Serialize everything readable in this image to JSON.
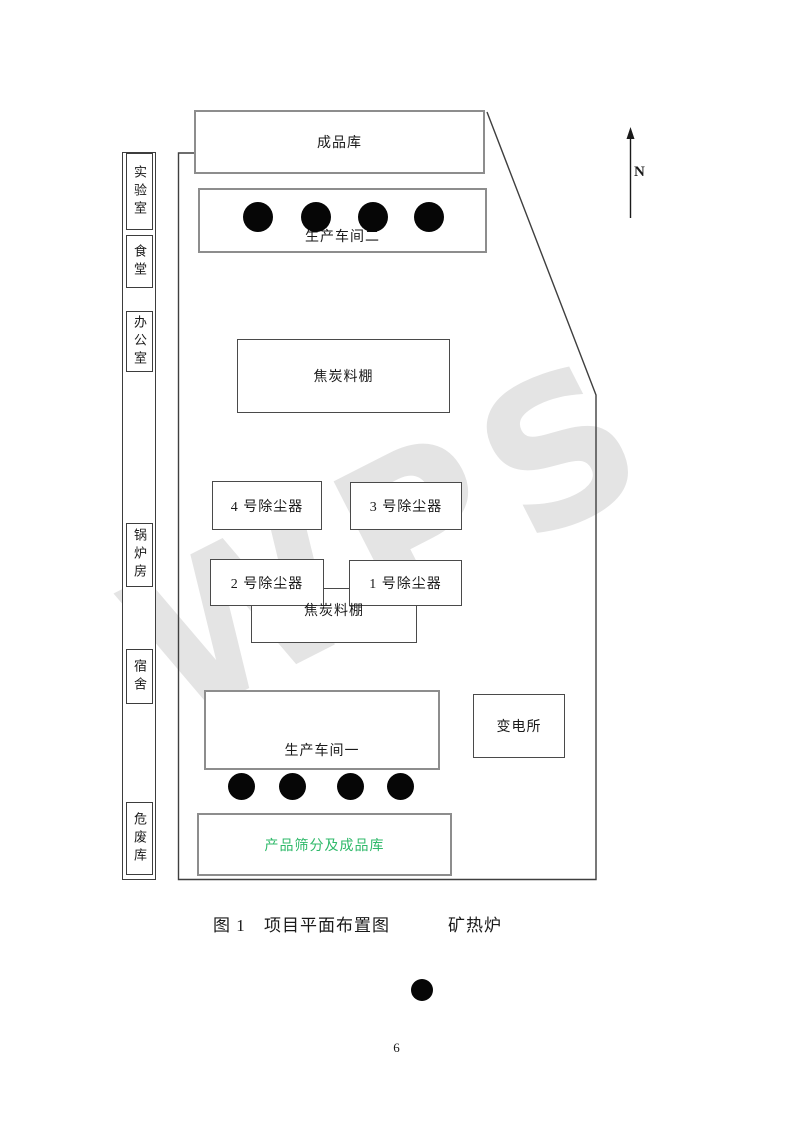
{
  "watermark": {
    "text": "WPS"
  },
  "compass": {
    "label": "N"
  },
  "side_strip": {
    "items": [
      {
        "id": "laboratory",
        "label": "实验室"
      },
      {
        "id": "canteen",
        "label": "食堂"
      },
      {
        "id": "office",
        "label": "办公室"
      },
      {
        "id": "boiler-room",
        "label": "锅炉房"
      },
      {
        "id": "dormitory",
        "label": "宿舍"
      },
      {
        "id": "hazardous-waste-warehouse",
        "label": "危废库"
      }
    ]
  },
  "buildings": {
    "finished_goods_warehouse": {
      "label": "成品库"
    },
    "workshop_2": {
      "label": "生产车间二",
      "furnace_count": 4
    },
    "coke_shed_upper": {
      "label": "焦炭料棚"
    },
    "dust_collector_4": {
      "label": "4 号除尘器"
    },
    "dust_collector_3": {
      "label": "3 号除尘器"
    },
    "dust_collector_2": {
      "label": "2 号除尘器"
    },
    "dust_collector_1": {
      "label": "1 号除尘器"
    },
    "coke_shed_lower": {
      "label": "焦炭料棚"
    },
    "workshop_1": {
      "label": "生产车间一",
      "furnace_count": 4
    },
    "substation": {
      "label": "变电所"
    },
    "product_screening_warehouse": {
      "label": "产品筛分及成品库",
      "text_color": "#2fb96a"
    }
  },
  "caption": {
    "figure_label": "图 1",
    "title": "项目平面布置图",
    "legend_label": "矿热炉"
  },
  "page": {
    "number": "6"
  }
}
